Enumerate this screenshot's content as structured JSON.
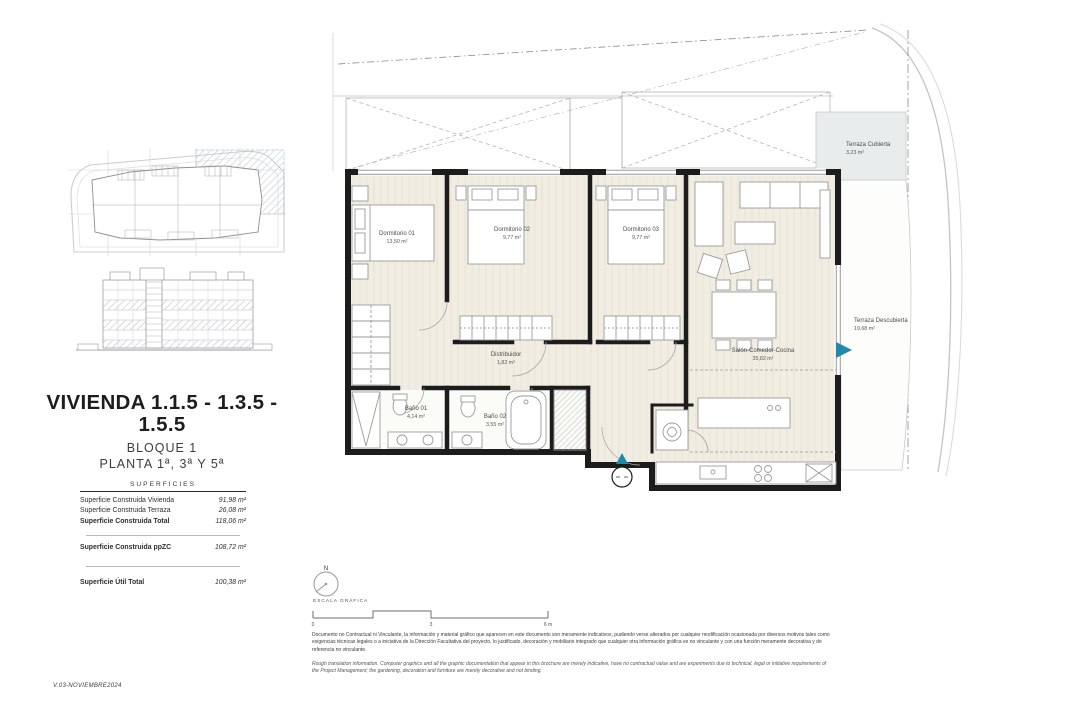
{
  "document": {
    "version": "V.03-NOVIEMBRE2024"
  },
  "title_block": {
    "title": "VIVIENDA 1.1.5 - 1.3.5 - 1.5.5",
    "block": "BLOQUE 1",
    "floors": "PLANTA 1ª, 3ª Y 5ª"
  },
  "superficies": {
    "heading": "SUPERFICIES",
    "rows": [
      {
        "label": "Superficie Construida Vivienda",
        "value": "91,98 m²"
      },
      {
        "label": "Superficie Construida Terraza",
        "value": "26,08 m²"
      },
      {
        "label": "Superficie Construida Total",
        "value": "118,06 m²"
      },
      {
        "label": "Superficie Construida ppZC",
        "value": "108,72 m²"
      },
      {
        "label": "Superficie Útil Total",
        "value": "100,38 m²"
      }
    ]
  },
  "rooms": [
    {
      "name": "Dormitorio 01",
      "area": "13,50 m²"
    },
    {
      "name": "Dormitorio 02",
      "area": "9,77 m²"
    },
    {
      "name": "Dormitorio 03",
      "area": "9,77 m²"
    },
    {
      "name": "Distribuidor",
      "area": "1,82 m²"
    },
    {
      "name": "Baño 01",
      "area": "4,14 m²"
    },
    {
      "name": "Baño 02",
      "area": "3,55 m²"
    },
    {
      "name": "Salón-Comedor-Cocina",
      "area": "35,82 m²"
    },
    {
      "name": "Terraza Cubierta",
      "area": "3,23 m²"
    },
    {
      "name": "Terraza Descubierta",
      "area": "19,68 m²"
    }
  ],
  "compass": {
    "north_label": "N"
  },
  "scale_bar": {
    "label": "ESCALA GRÁFICA",
    "ticks": [
      "0",
      "3",
      "6 m"
    ]
  },
  "disclaimer": {
    "spanish": "Documento no Contractual ni Vinculante, la información y material gráfico que aparecen en este documento son meramente indicativos, pudiendo verse alterados por cualquier modificación ocasionada por diversos motivos tales como exigencias técnicas legales o a iniciativa de la Dirección Facultativa del proyecto, lo justificado, decoración y mobiliario integrado que cualquier otra información gráfica es no vinculante y con una función meramente decorativa y de referencia no vinculante.",
    "english": "Rough translation information. Computer graphics and all the graphic documentation that appear in this brochure are merely indicative, have no contractual value and are experiments due to technical, legal or initiative requirements of the Project Management; the gardening, decoration and furniture are merely decorative and not binding."
  },
  "colors": {
    "accent_teal": "#2289ad",
    "wall": "#1c1c1c",
    "floor": "#f1ede2",
    "highlight_hatch": "#a9bcc4",
    "covered_terrace_fill": "#e9ecec"
  }
}
